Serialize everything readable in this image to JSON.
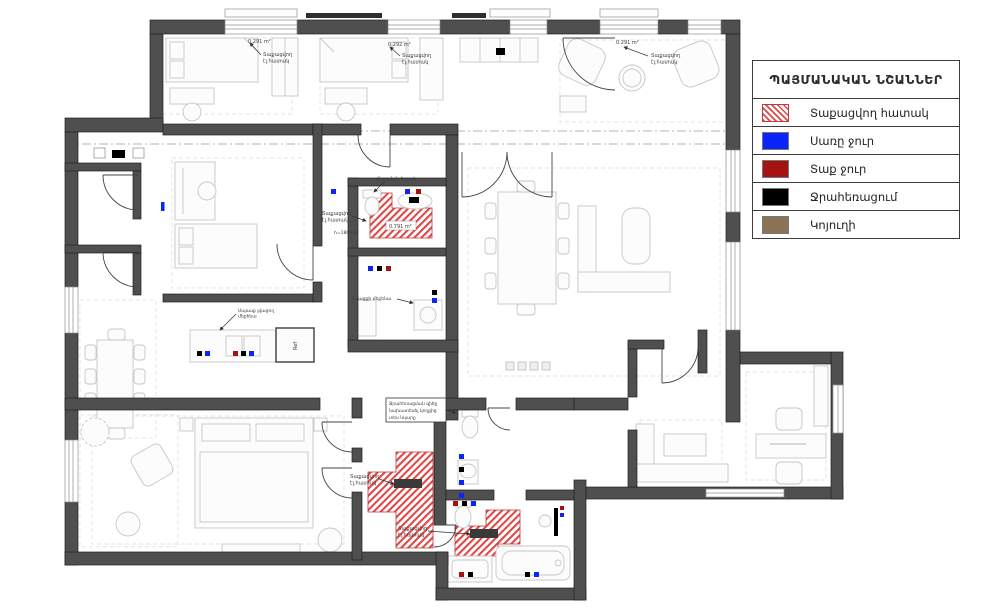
{
  "legend": {
    "title": "ՊԱՅՄԱՆԱԿԱՆ ՆՇԱՆՆԵՐ",
    "items": [
      {
        "label": "Տաքացվող հատակ",
        "swatch": "hatch"
      },
      {
        "label": "Սառը ջուր",
        "swatch": "#0b24fb"
      },
      {
        "label": "Տաք ջուր",
        "swatch": "#a41212"
      },
      {
        "label": "Ջրահեռացում",
        "swatch": "#000000"
      },
      {
        "label": "Կոյուղի",
        "swatch": "#8a7357"
      }
    ]
  },
  "plan": {
    "rooms": {
      "room1_area": "0.291 m²",
      "room2_area": "0.292 m²",
      "room3_area": "0.291 m²"
    },
    "hatch_areas": {
      "bath_small": "0.791 m²",
      "hall": "4.505 m²",
      "bath_big": "1.581 m²"
    },
    "callout": {
      "line1": "Տաքացվող",
      "line2": "էլ.հատակ"
    },
    "labels": {
      "washing_machine": "Լվացքի մեքենա",
      "dishwasher_line1": "Սպասք լվացող",
      "dishwasher_line2": "մեքենա",
      "vent": "Ոռոգման ծորակ",
      "height": "h=1800մմ",
      "fridge": "Ref",
      "note_line1": "Ջրահեռացման գիծը",
      "note_line2": "նախատեսել կողքից",
      "note_line3": "տես նկարը"
    },
    "colors": {
      "wall": "#4f4f4f",
      "heated_floor": "#e04848",
      "cold_water": "#0b24fb",
      "hot_water": "#a41212",
      "drainage": "#000000",
      "sewer": "#8a7357"
    }
  }
}
